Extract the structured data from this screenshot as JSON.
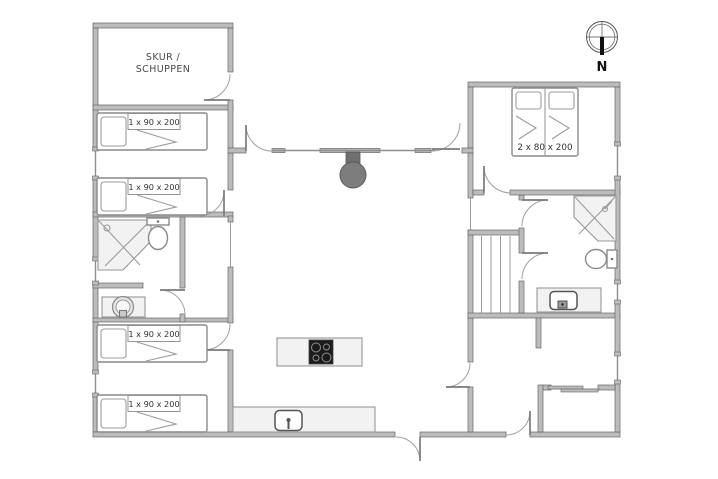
{
  "labels": {
    "shed_line1": "SKUR /",
    "shed_line2": "SCHUPPEN",
    "single_bed": "1 x 90 x 200",
    "double_bed": "2 x 80 x 200",
    "compass_north": "N"
  },
  "colors": {
    "background": "#ffffff",
    "wall_fill": "#bcbcbc",
    "wall_stroke": "#666666",
    "fixture_fill": "#f2f2f2",
    "stove": "#7d7d7d",
    "cooktop": "#1b1b1b"
  }
}
